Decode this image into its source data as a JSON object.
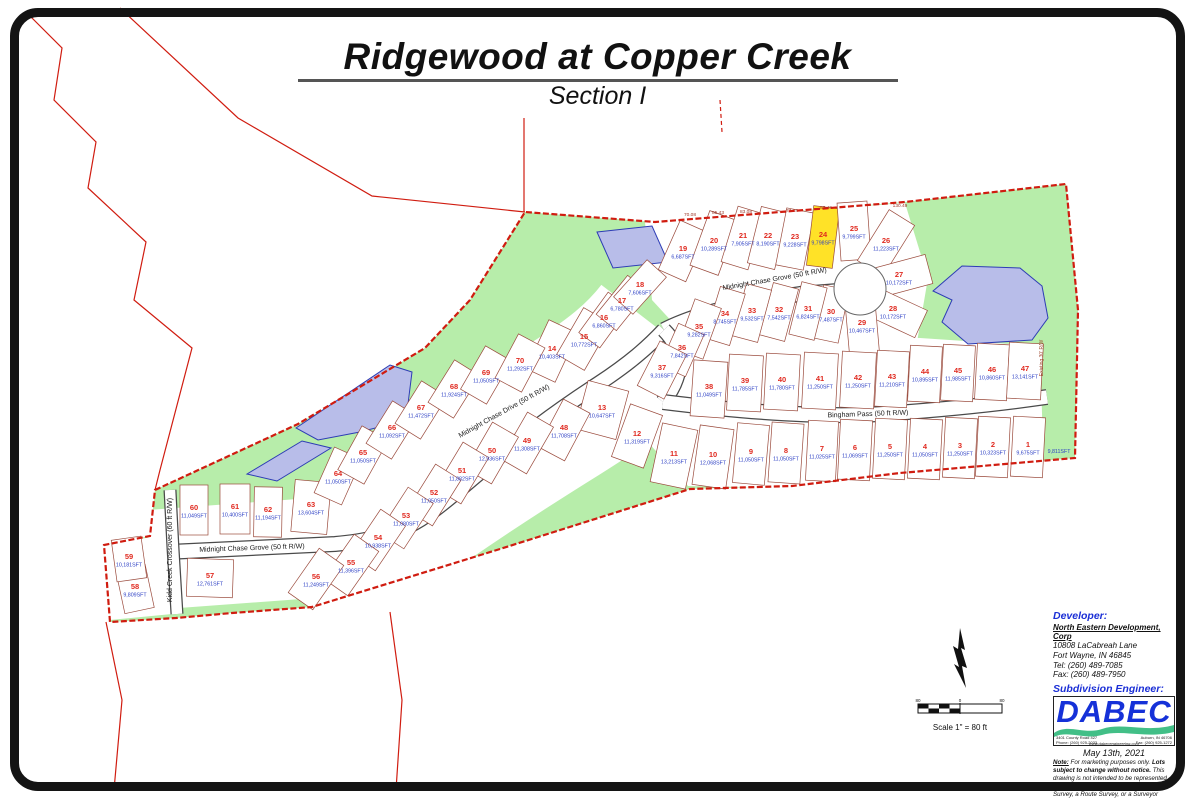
{
  "title": {
    "main": "Ridgewood at Copper Creek",
    "sub": "Section I"
  },
  "scale": {
    "left": "80",
    "zero": "0",
    "right": "80",
    "caption": "Scale 1\" = 80 ft"
  },
  "info": {
    "developer_heading": "Developer:",
    "developer_name": "North Eastern Development, Corp",
    "developer_address1": "10808 LaCabreah Lane",
    "developer_address2": "Fort Wayne, IN 46845",
    "developer_tel": "Tel: (260) 489-7085",
    "developer_fax": "Fax: (260) 489-7950",
    "engineer_heading": "Subdivision Engineer:",
    "logo_text": "DABEC",
    "logo_addr_left1": "3401 County Road 427",
    "logo_addr_left2": "Phone: (260) 925-2033",
    "logo_addr_right1": "Auburn, IN 46706",
    "logo_addr_right2": "Fax: (260) 925-1272",
    "logo_url": "www.dabecengineering.com",
    "date": "May 13th, 2021",
    "note_label": "Note:",
    "note_pre": "For marketing purposes only.",
    "note_bold": "Lots subject to change without notice.",
    "note_rest": "This drawing is not intended to be represented as a Retracement or Original Boundary Survey, a Route Survey, or a Surveyor Location Report as defined in 865 IAC 1-12"
  },
  "map": {
    "highlight_lot": 24,
    "colors": {
      "green": "#b7edaa",
      "pond": "#b8bde9",
      "pond_stroke": "#2d3cb5",
      "boundary": "#d01c10",
      "lot_line": "#9a4a3c",
      "lot_number": "#e02a20",
      "lot_area": "#2b3ec4",
      "highlight": "#ffe227",
      "dim": "#9c3526",
      "street_text": "#1a1a1a"
    },
    "street_labels": [
      {
        "text": "Midnight Chase Grove (50 ft R/W)",
        "x": 775,
        "y": 281,
        "r": -10
      },
      {
        "text": "Midnight Chase Drive (50 ft R/W)",
        "x": 505,
        "y": 413,
        "r": -29
      },
      {
        "text": "Bingham Pass  (50 ft R/W)",
        "x": 868,
        "y": 416,
        "r": -2
      },
      {
        "text": "Midnight Chase Grove (50 ft R/W)",
        "x": 252,
        "y": 550,
        "r": -2
      },
      {
        "text": "Kidd Creek Crossover (60 ft R/W)",
        "x": 172,
        "y": 550,
        "r": -90
      }
    ],
    "dims": [
      {
        "t": "70.08",
        "x": 690,
        "y": 216
      },
      {
        "t": "85.43",
        "x": 718,
        "y": 214
      },
      {
        "t": "83.08",
        "x": 746,
        "y": 213
      },
      {
        "t": "77.28",
        "x": 792,
        "y": 212
      },
      {
        "t": "87.45",
        "x": 826,
        "y": 209
      },
      {
        "t": "130.49",
        "x": 900,
        "y": 207
      }
    ],
    "edge_label": {
      "t": "Existing 30' R/W",
      "x": 1043,
      "y": 358,
      "r": -90
    },
    "open_space_label": {
      "t": "9,811SFT",
      "x": 1059,
      "y": 453
    },
    "lots": [
      {
        "n": 1,
        "a": "9,675SFT",
        "x": 1028,
        "y": 447,
        "r": 3,
        "w": 32,
        "h": 60
      },
      {
        "n": 2,
        "a": "10,323SFT",
        "x": 993,
        "y": 447,
        "r": 3,
        "w": 32,
        "h": 60
      },
      {
        "n": 3,
        "a": "11,250SFT",
        "x": 960,
        "y": 448,
        "r": 3,
        "w": 32,
        "h": 60
      },
      {
        "n": 4,
        "a": "11,050SFT",
        "x": 925,
        "y": 449,
        "r": 3,
        "w": 32,
        "h": 60
      },
      {
        "n": 5,
        "a": "11,250SFT",
        "x": 890,
        "y": 449,
        "r": 3,
        "w": 32,
        "h": 60
      },
      {
        "n": 6,
        "a": "11,069SFT",
        "x": 855,
        "y": 450,
        "r": 3,
        "w": 32,
        "h": 60
      },
      {
        "n": 7,
        "a": "11,025SFT",
        "x": 822,
        "y": 451,
        "r": 3,
        "w": 30,
        "h": 60
      },
      {
        "n": 8,
        "a": "11,050SFT",
        "x": 786,
        "y": 453,
        "r": 4,
        "w": 32,
        "h": 60
      },
      {
        "n": 9,
        "a": "11,050SFT",
        "x": 751,
        "y": 454,
        "r": 5,
        "w": 32,
        "h": 60
      },
      {
        "n": 10,
        "a": "12,068SFT",
        "x": 713,
        "y": 457,
        "r": 8,
        "w": 34,
        "h": 60
      },
      {
        "n": 11,
        "a": "13,213SFT",
        "x": 674,
        "y": 456,
        "r": 12,
        "w": 36,
        "h": 60
      },
      {
        "n": 12,
        "a": "11,319SFT",
        "x": 637,
        "y": 436,
        "r": 20,
        "w": 34,
        "h": 56
      },
      {
        "n": 13,
        "a": "10,647SFT",
        "x": 602,
        "y": 410,
        "r": 15,
        "w": 42,
        "h": 50
      },
      {
        "n": 14,
        "a": "10,403SFT",
        "x": 552,
        "y": 351,
        "r": 25,
        "w": 32,
        "h": 54
      },
      {
        "n": 15,
        "a": "10,772SFT",
        "x": 584,
        "y": 339,
        "r": 30,
        "w": 32,
        "h": 54
      },
      {
        "n": 16,
        "a": "6,860SFT",
        "x": 604,
        "y": 320,
        "r": 36,
        "w": 26,
        "h": 50
      },
      {
        "n": 17,
        "a": "6,780SFT",
        "x": 622,
        "y": 303,
        "r": 39,
        "w": 26,
        "h": 50
      },
      {
        "n": 18,
        "a": "7,606SFT",
        "x": 640,
        "y": 287,
        "r": 42,
        "w": 26,
        "h": 50
      },
      {
        "n": 19,
        "a": "6,687SFT",
        "x": 683,
        "y": 251,
        "r": 24,
        "w": 30,
        "h": 54
      },
      {
        "n": 20,
        "a": "10,289SFT",
        "x": 714,
        "y": 243,
        "r": 20,
        "w": 30,
        "h": 58
      },
      {
        "n": 21,
        "a": "7,905SFT",
        "x": 743,
        "y": 238,
        "r": 17,
        "w": 28,
        "h": 58
      },
      {
        "n": 22,
        "a": "8,190SFT",
        "x": 768,
        "y": 238,
        "r": 14,
        "w": 28,
        "h": 58
      },
      {
        "n": 23,
        "a": "9,228SFT",
        "x": 795,
        "y": 239,
        "r": 11,
        "w": 28,
        "h": 58
      },
      {
        "n": 24,
        "a": "9,798SFT",
        "x": 823,
        "y": 237,
        "r": 7,
        "w": 26,
        "h": 60
      },
      {
        "n": 25,
        "a": "9,799SFT",
        "x": 854,
        "y": 231,
        "r": -4,
        "w": 30,
        "h": 58
      },
      {
        "n": 26,
        "a": "11,223SFT",
        "x": 886,
        "y": 243,
        "r": 32,
        "w": 30,
        "h": 60
      },
      {
        "n": 27,
        "a": "10,172SFT",
        "x": 899,
        "y": 277,
        "r": 75,
        "w": 30,
        "h": 62
      },
      {
        "n": 28,
        "a": "10,172SFT",
        "x": 893,
        "y": 311,
        "r": 115,
        "w": 30,
        "h": 62
      },
      {
        "n": 29,
        "a": "10,467SFT",
        "x": 862,
        "y": 325,
        "r": -5,
        "w": 30,
        "h": 58
      },
      {
        "n": 30,
        "a": "7,487SFT",
        "x": 831,
        "y": 314,
        "r": 12,
        "w": 26,
        "h": 54
      },
      {
        "n": 31,
        "a": "6,824SFT",
        "x": 808,
        "y": 311,
        "r": 14,
        "w": 26,
        "h": 54
      },
      {
        "n": 32,
        "a": "7,542SFT",
        "x": 779,
        "y": 312,
        "r": 15,
        "w": 26,
        "h": 54
      },
      {
        "n": 33,
        "a": "9,532SFT",
        "x": 752,
        "y": 313,
        "r": 15,
        "w": 26,
        "h": 54
      },
      {
        "n": 34,
        "a": "8,745SFT",
        "x": 725,
        "y": 316,
        "r": 17,
        "w": 26,
        "h": 54
      },
      {
        "n": 35,
        "a": "9,282SFT",
        "x": 699,
        "y": 329,
        "r": 20,
        "w": 28,
        "h": 54
      },
      {
        "n": 36,
        "a": "7,842SFT",
        "x": 682,
        "y": 350,
        "r": 24,
        "w": 28,
        "h": 46
      },
      {
        "n": 37,
        "a": "9,316SFT",
        "x": 662,
        "y": 370,
        "r": 27,
        "w": 30,
        "h": 50
      },
      {
        "n": 38,
        "a": "11,049SFT",
        "x": 709,
        "y": 389,
        "r": 4,
        "w": 34,
        "h": 56
      },
      {
        "n": 39,
        "a": "11,785SFT",
        "x": 745,
        "y": 383,
        "r": 3,
        "w": 34,
        "h": 56
      },
      {
        "n": 40,
        "a": "11,780SFT",
        "x": 782,
        "y": 382,
        "r": 3,
        "w": 34,
        "h": 56
      },
      {
        "n": 41,
        "a": "11,250SFT",
        "x": 820,
        "y": 381,
        "r": 3,
        "w": 34,
        "h": 56
      },
      {
        "n": 42,
        "a": "11,250SFT",
        "x": 858,
        "y": 380,
        "r": 3,
        "w": 34,
        "h": 56
      },
      {
        "n": 43,
        "a": "11,210SFT",
        "x": 892,
        "y": 379,
        "r": 3,
        "w": 32,
        "h": 56
      },
      {
        "n": 44,
        "a": "10,895SFT",
        "x": 925,
        "y": 374,
        "r": 3,
        "w": 32,
        "h": 56
      },
      {
        "n": 45,
        "a": "11,985SFT",
        "x": 958,
        "y": 373,
        "r": 3,
        "w": 32,
        "h": 56
      },
      {
        "n": 46,
        "a": "10,860SFT",
        "x": 992,
        "y": 372,
        "r": 3,
        "w": 32,
        "h": 56
      },
      {
        "n": 47,
        "a": "13,141SFT",
        "x": 1025,
        "y": 371,
        "r": 3,
        "w": 34,
        "h": 56
      },
      {
        "n": 48,
        "a": "11,708SFT",
        "x": 564,
        "y": 430,
        "r": 28,
        "w": 30,
        "h": 54
      },
      {
        "n": 49,
        "a": "11,308SFT",
        "x": 527,
        "y": 443,
        "r": 30,
        "w": 30,
        "h": 54
      },
      {
        "n": 50,
        "a": "12,936SFT",
        "x": 492,
        "y": 453,
        "r": 30,
        "w": 30,
        "h": 54
      },
      {
        "n": 51,
        "a": "11,882SFT",
        "x": 462,
        "y": 473,
        "r": 31,
        "w": 30,
        "h": 54
      },
      {
        "n": 52,
        "a": "11,050SFT",
        "x": 434,
        "y": 495,
        "r": 32,
        "w": 30,
        "h": 54
      },
      {
        "n": 53,
        "a": "11,080SFT",
        "x": 406,
        "y": 518,
        "r": 33,
        "w": 30,
        "h": 54
      },
      {
        "n": 54,
        "a": "10,938SFT",
        "x": 378,
        "y": 540,
        "r": 34,
        "w": 30,
        "h": 54
      },
      {
        "n": 55,
        "a": "11,396SFT",
        "x": 351,
        "y": 565,
        "r": 35,
        "w": 30,
        "h": 54
      },
      {
        "n": 56,
        "a": "11,249SFT",
        "x": 316,
        "y": 579,
        "r": 35,
        "w": 30,
        "h": 54
      },
      {
        "n": 57,
        "a": "12,761SFT",
        "x": 210,
        "y": 578,
        "r": 2,
        "w": 46,
        "h": 38
      },
      {
        "n": 58,
        "a": "9,809SFT",
        "x": 135,
        "y": 589,
        "r": -12,
        "w": 30,
        "h": 44
      },
      {
        "n": 59,
        "a": "10,181SFT",
        "x": 129,
        "y": 559,
        "r": -8,
        "w": 30,
        "h": 42
      },
      {
        "n": 60,
        "a": "11,049SFT",
        "x": 194,
        "y": 510,
        "r": 0,
        "w": 28,
        "h": 50
      },
      {
        "n": 61,
        "a": "10,400SFT",
        "x": 235,
        "y": 509,
        "r": 0,
        "w": 30,
        "h": 50
      },
      {
        "n": 62,
        "a": "11,194SFT",
        "x": 268,
        "y": 512,
        "r": 1,
        "w": 28,
        "h": 50
      },
      {
        "n": 63,
        "a": "13,604SFT",
        "x": 311,
        "y": 507,
        "r": 5,
        "w": 36,
        "h": 52
      },
      {
        "n": 64,
        "a": "11,050SFT",
        "x": 338,
        "y": 476,
        "r": 24,
        "w": 30,
        "h": 50
      },
      {
        "n": 65,
        "a": "11,050SFT",
        "x": 363,
        "y": 455,
        "r": 29,
        "w": 30,
        "h": 50
      },
      {
        "n": 66,
        "a": "11,092SFT",
        "x": 392,
        "y": 430,
        "r": 32,
        "w": 30,
        "h": 50
      },
      {
        "n": 67,
        "a": "11,472SFT",
        "x": 421,
        "y": 410,
        "r": 32,
        "w": 30,
        "h": 50
      },
      {
        "n": 68,
        "a": "11,924SFT",
        "x": 454,
        "y": 389,
        "r": 32,
        "w": 30,
        "h": 50
      },
      {
        "n": 69,
        "a": "11,050SFT",
        "x": 486,
        "y": 375,
        "r": 30,
        "w": 30,
        "h": 50
      },
      {
        "n": 70,
        "a": "11,292SFT",
        "x": 520,
        "y": 363,
        "r": 28,
        "w": 30,
        "h": 50
      }
    ]
  }
}
